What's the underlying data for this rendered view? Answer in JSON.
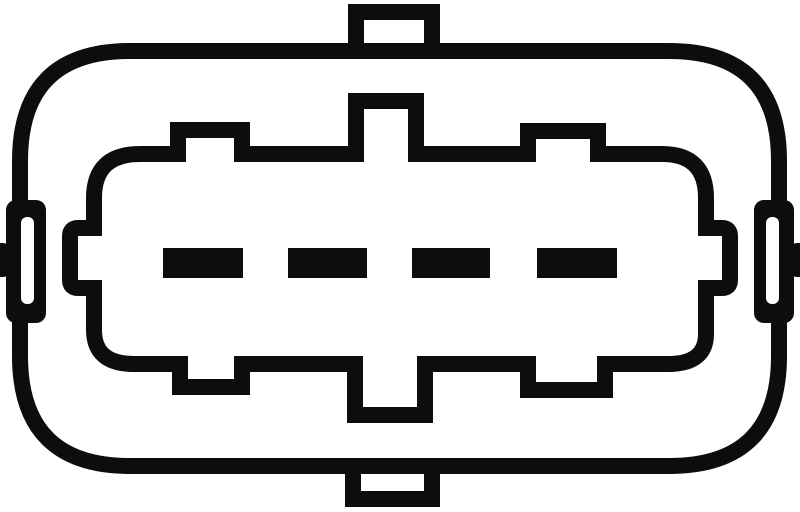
{
  "figure": {
    "description": "Monochrome technical line drawing of a 4-pin oval electrical connector, front face view",
    "colors": {
      "line": "#0d0d0d",
      "background": "#ffffff"
    },
    "pin_count": 4
  },
  "pins": [
    {
      "label": "terminal-1",
      "x": 163,
      "y": 248,
      "width": 80,
      "height": 30
    },
    {
      "label": "terminal-2",
      "x": 288,
      "y": 248,
      "width": 79,
      "height": 30
    },
    {
      "label": "terminal-3",
      "x": 412,
      "y": 248,
      "width": 78,
      "height": 30
    },
    {
      "label": "terminal-4",
      "x": 537,
      "y": 248,
      "width": 80,
      "height": 30
    }
  ],
  "parts": {
    "housing": "outer oval housing",
    "top_latch": "top latch tab",
    "bottom_latch": "bottom latch tab",
    "plug_face": "inner keyed plug-face contour",
    "left_bracket": "left slotted mounting bracket",
    "right_bracket": "right slotted mounting bracket",
    "left_nub": "left edge clip nub",
    "right_nub": "right edge clip nub",
    "terminals": "terminal blade row"
  }
}
